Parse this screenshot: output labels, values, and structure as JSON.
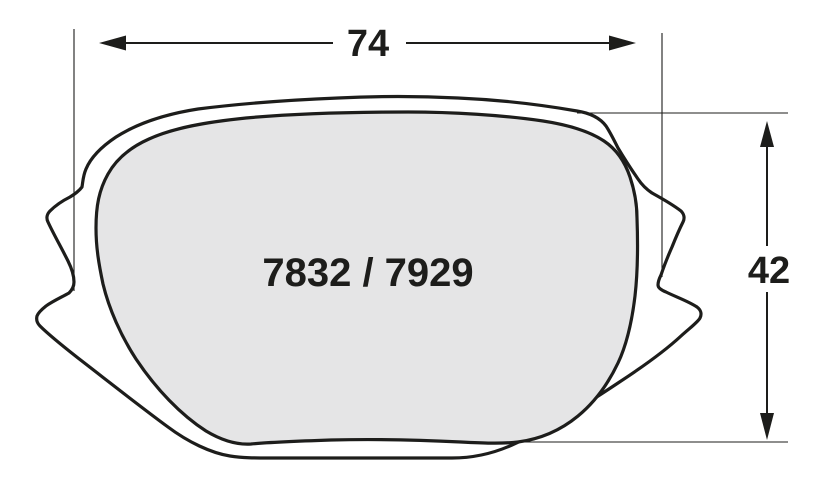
{
  "diagram": {
    "part_label": "7832 / 7929",
    "width_label": "74",
    "height_label": "42"
  },
  "measurements": {
    "width": 74,
    "height": 42,
    "part_numbers": [
      "7832",
      "7929"
    ]
  },
  "colors": {
    "line": "#1d1d1b",
    "pad_fill": "#e5e5e6",
    "background": "#ffffff"
  }
}
